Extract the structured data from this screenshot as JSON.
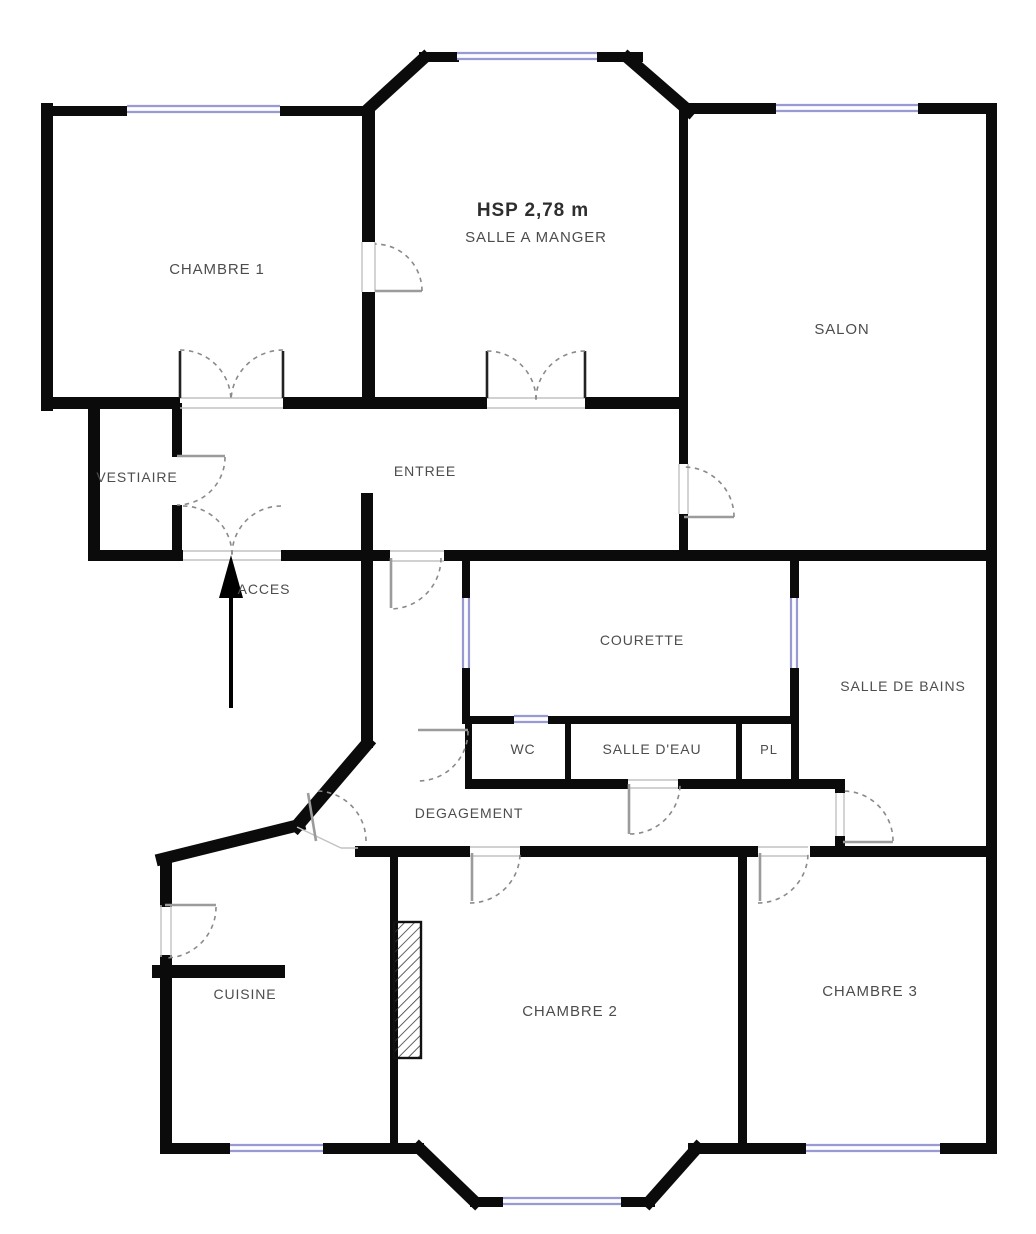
{
  "palette": {
    "wall": "#0b0b0b",
    "window_frame": "#9a9ad2",
    "window_fill": "#fdfdff",
    "door_leaf": "#9b9b9b",
    "door_arc": "#8a8a8a",
    "threshold": "#c2c2c2",
    "label": "#4d4d4d",
    "title": "#2e2e2e",
    "hatch_line": "#3a3a3a"
  },
  "plan": {
    "canvas": {
      "w": 1036,
      "h": 1234
    },
    "labels": [
      {
        "text": "CHAMBRE 1",
        "x": 217,
        "y": 274,
        "s": 15,
        "w": 400
      },
      {
        "text": "HSP 2,78 m",
        "x": 533,
        "y": 216,
        "s": 19,
        "w": 600,
        "c": "#2e2e2e"
      },
      {
        "text": "SALLE A MANGER",
        "x": 536,
        "y": 242,
        "s": 15,
        "w": 400
      },
      {
        "text": "SALON",
        "x": 842,
        "y": 334,
        "s": 15,
        "w": 400
      },
      {
        "text": "VESTIAIRE",
        "x": 137,
        "y": 482,
        "s": 14,
        "w": 400
      },
      {
        "text": "ENTREE",
        "x": 425,
        "y": 476,
        "s": 14,
        "w": 400
      },
      {
        "text": "ACCES",
        "x": 264,
        "y": 594,
        "s": 14,
        "w": 400
      },
      {
        "text": "COURETTE",
        "x": 642,
        "y": 645,
        "s": 14,
        "w": 400
      },
      {
        "text": "SALLE DE BAINS",
        "x": 903,
        "y": 691,
        "s": 14,
        "w": 400
      },
      {
        "text": "WC",
        "x": 523,
        "y": 754,
        "s": 14,
        "w": 400
      },
      {
        "text": "SALLE D'EAU",
        "x": 652,
        "y": 754,
        "s": 14,
        "w": 400
      },
      {
        "text": "PL",
        "x": 769,
        "y": 754,
        "s": 13,
        "w": 400
      },
      {
        "text": "DEGAGEMENT",
        "x": 469,
        "y": 818,
        "s": 14,
        "w": 400
      },
      {
        "text": "CUISINE",
        "x": 245,
        "y": 999,
        "s": 14,
        "w": 400
      },
      {
        "text": "CHAMBRE 2",
        "x": 570,
        "y": 1016,
        "s": 15,
        "w": 400
      },
      {
        "text": "CHAMBRE 3",
        "x": 870,
        "y": 996,
        "s": 15,
        "w": 400
      }
    ],
    "walls": [
      [
        41,
        103,
        12,
        308
      ],
      [
        41,
        106,
        86,
        10
      ],
      [
        280,
        106,
        88,
        10
      ],
      [
        419,
        52,
        40,
        10
      ],
      [
        597,
        52,
        46,
        10
      ],
      [
        683,
        103,
        93,
        11
      ],
      [
        918,
        103,
        79,
        11
      ],
      [
        986,
        103,
        11,
        1049
      ],
      [
        41,
        397,
        139,
        12
      ],
      [
        283,
        397,
        92,
        12
      ],
      [
        375,
        397,
        112,
        12
      ],
      [
        585,
        397,
        98,
        12
      ],
      [
        362,
        106,
        13,
        136
      ],
      [
        362,
        292,
        13,
        117
      ],
      [
        679,
        108,
        9,
        356
      ],
      [
        679,
        514,
        9,
        42
      ],
      [
        88,
        403,
        12,
        158
      ],
      [
        172,
        403,
        10,
        54
      ],
      [
        172,
        505,
        10,
        56
      ],
      [
        88,
        550,
        95,
        11
      ],
      [
        281,
        550,
        109,
        11
      ],
      [
        444,
        550,
        24,
        11
      ],
      [
        468,
        550,
        215,
        11
      ],
      [
        683,
        550,
        314,
        11
      ],
      [
        361,
        493,
        12,
        255
      ],
      [
        462,
        561,
        8,
        37
      ],
      [
        462,
        668,
        8,
        56
      ],
      [
        790,
        561,
        9,
        37
      ],
      [
        790,
        668,
        9,
        56
      ],
      [
        791,
        724,
        8,
        56
      ],
      [
        462,
        716,
        52,
        8
      ],
      [
        548,
        716,
        250,
        8
      ],
      [
        465,
        724,
        7,
        56
      ],
      [
        565,
        724,
        6,
        56
      ],
      [
        736,
        724,
        6,
        56
      ],
      [
        465,
        779,
        163,
        10
      ],
      [
        678,
        779,
        162,
        10
      ],
      [
        835,
        779,
        10,
        14
      ],
      [
        835,
        836,
        10,
        12
      ],
      [
        355,
        846,
        115,
        11
      ],
      [
        520,
        846,
        238,
        11
      ],
      [
        810,
        846,
        187,
        11
      ],
      [
        738,
        846,
        9,
        305
      ],
      [
        390,
        846,
        8,
        305
      ],
      [
        160,
        855,
        12,
        52
      ],
      [
        160,
        955,
        12,
        198
      ],
      [
        152,
        965,
        133,
        13
      ],
      [
        160,
        1143,
        70,
        11
      ],
      [
        323,
        1143,
        101,
        11
      ],
      [
        688,
        1143,
        118,
        11
      ],
      [
        940,
        1143,
        57,
        11
      ],
      [
        470,
        1197,
        33,
        10
      ],
      [
        621,
        1197,
        34,
        10
      ]
    ],
    "diagonal_walls": [
      [
        366,
        111,
        424,
        58,
        12
      ],
      [
        628,
        58,
        689,
        111,
        12
      ],
      [
        367,
        744,
        297,
        826,
        13
      ],
      [
        299,
        825,
        162,
        859,
        12
      ],
      [
        419,
        1148,
        475,
        1202,
        12
      ],
      [
        649,
        1202,
        697,
        1148,
        12
      ]
    ],
    "windows": [
      {
        "x": 127,
        "y": 105,
        "len": 153,
        "o": "h"
      },
      {
        "x": 457,
        "y": 52,
        "len": 140,
        "o": "h"
      },
      {
        "x": 776,
        "y": 104,
        "len": 142,
        "o": "h"
      },
      {
        "x": 462,
        "y": 598,
        "len": 70,
        "o": "v"
      },
      {
        "x": 790,
        "y": 598,
        "len": 70,
        "o": "v"
      },
      {
        "x": 514,
        "y": 715,
        "len": 34,
        "o": "h"
      },
      {
        "x": 230,
        "y": 1144,
        "len": 93,
        "o": "h"
      },
      {
        "x": 503,
        "y": 1197,
        "len": 118,
        "o": "h"
      },
      {
        "x": 806,
        "y": 1144,
        "len": 134,
        "o": "h"
      }
    ],
    "door_leaves": [
      [
        375,
        291,
        422,
        291
      ],
      [
        684,
        517,
        734,
        517
      ],
      [
        177,
        456,
        225,
        456
      ],
      [
        391,
        558,
        391,
        608
      ],
      [
        418,
        730,
        468,
        730
      ],
      [
        629,
        784,
        629,
        834
      ],
      [
        843,
        842,
        893,
        842
      ],
      [
        472,
        853,
        472,
        901
      ],
      [
        760,
        853,
        760,
        901
      ],
      [
        165,
        905,
        216,
        905
      ],
      [
        316,
        841,
        308,
        793
      ]
    ],
    "double_door_leaves": [
      [
        180,
        351,
        180,
        398
      ],
      [
        283,
        351,
        283,
        398
      ],
      [
        487,
        351,
        487,
        398
      ],
      [
        585,
        351,
        585,
        398
      ]
    ],
    "door_arcs": [
      "M422,291 A47,47 0 0 0 375,244",
      "M734,517 A50,50 0 0 0 684,467",
      "M225,457 A48,48 0 0 1 177,505",
      "M441,558 A51,51 0 0 1 390,609",
      "M468,731 A50,50 0 0 1 418,781",
      "M630,834 A50,50 0 0 0 680,784",
      "M893,841 A50,50 0 0 0 843,791",
      "M470,903 A50,50 0 0 0 520,853",
      "M758,903 A50,50 0 0 0 808,853",
      "M216,907 A51,51 0 0 1 165,958",
      "M318,791 A50,50 0 0 1 366,841",
      "M180,350 A51,51 0 0 1 231,401",
      "M283,350 A52,52 0 0 0 231,401",
      "M487,351 A49,49 0 0 1 536,400",
      "M585,351 A49,49 0 0 0 536,400",
      "M183,506 A49,49 0 0 1 232,555",
      "M281,506 A49,49 0 0 0 232,555"
    ],
    "thresholds": [
      [
        183,
        551,
        281,
        551
      ],
      [
        183,
        560,
        281,
        560
      ],
      [
        180,
        398,
        283,
        398
      ],
      [
        180,
        408,
        283,
        408
      ],
      [
        487,
        398,
        585,
        398
      ],
      [
        487,
        408,
        585,
        408
      ],
      [
        390,
        551,
        444,
        551
      ],
      [
        390,
        561,
        444,
        561
      ],
      [
        679,
        464,
        679,
        514
      ],
      [
        688,
        464,
        688,
        514
      ],
      [
        362,
        242,
        362,
        292
      ],
      [
        375,
        242,
        375,
        292
      ],
      [
        628,
        780,
        678,
        780
      ],
      [
        628,
        788,
        678,
        788
      ],
      [
        470,
        847,
        520,
        847
      ],
      [
        470,
        856,
        520,
        856
      ],
      [
        758,
        847,
        808,
        847
      ],
      [
        758,
        856,
        808,
        856
      ],
      [
        836,
        793,
        836,
        836
      ],
      [
        844,
        793,
        844,
        836
      ],
      [
        161,
        905,
        161,
        957
      ],
      [
        171,
        905,
        171,
        957
      ],
      [
        297,
        827,
        341,
        848
      ],
      [
        341,
        848,
        358,
        848
      ]
    ],
    "chimney": {
      "x": 394,
      "y": 922,
      "w": 27,
      "h": 136
    },
    "access": {
      "label_index": 6,
      "arrow": {
        "x": 231,
        "y1": 708,
        "y2": 594,
        "head": "231,555 219,598 243,598"
      }
    }
  }
}
